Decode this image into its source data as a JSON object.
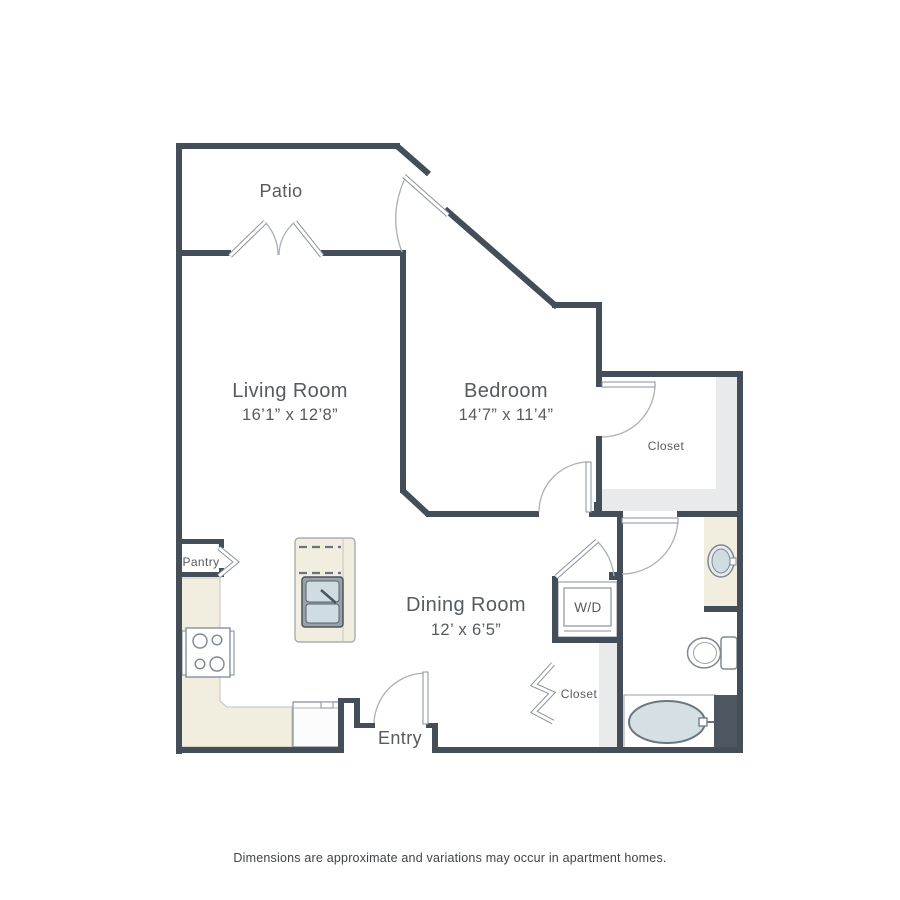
{
  "rooms": {
    "patio": {
      "label": "Patio"
    },
    "living_room": {
      "label": "Living Room",
      "dimensions": "16’1” x 12’8”"
    },
    "bedroom": {
      "label": "Bedroom",
      "dimensions": "14’7” x 11’4”"
    },
    "dining_room": {
      "label": "Dining Room",
      "dimensions": "12’ x 6’5”"
    },
    "bedroom_closet": {
      "label": "Closet"
    },
    "hall_closet": {
      "label": "Closet"
    },
    "laundry": {
      "label": "W/D"
    },
    "pantry": {
      "label": "Pantry"
    },
    "entry": {
      "label": "Entry"
    }
  },
  "fixtures": [
    "kitchen-island-sink",
    "range-stove",
    "refrigerator",
    "washer-dryer-unit",
    "bathroom-vanity-sink",
    "toilet",
    "bathtub",
    "closet-shelving"
  ],
  "disclaimer": "Dimensions are approximate and variations may occur in apartment homes.",
  "colors": {
    "wall": "#434e58",
    "counter": "#f1eee0",
    "closet_shading": "#e8eaec",
    "fixture_fill": "#d4e0e3",
    "fixture_stroke": "#7e8893",
    "accent_block": "#4d5761",
    "text": "#565b60"
  }
}
